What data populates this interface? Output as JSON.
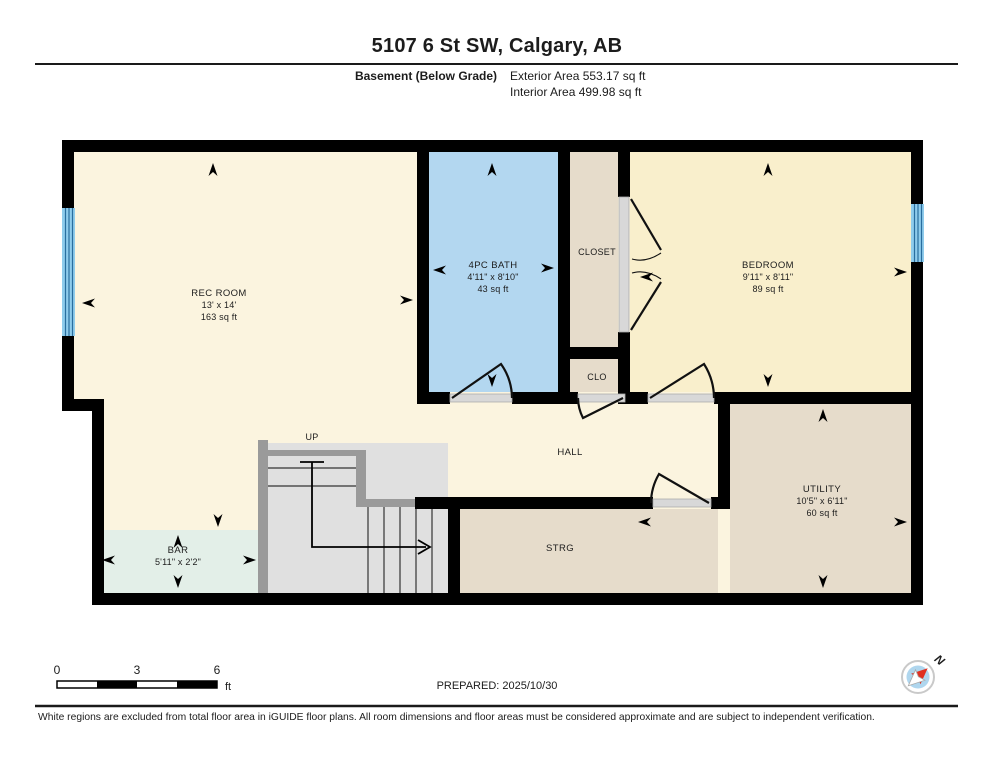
{
  "header": {
    "title": "5107 6 St SW, Calgary, AB",
    "floor_label": "Basement (Below Grade)",
    "exterior_area": "Exterior Area 553.17 sq ft",
    "interior_area": "Interior Area 499.98 sq ft"
  },
  "rooms": {
    "rec_room": {
      "name": "REC ROOM",
      "dims": "13' x 14'",
      "area": "163 sq ft"
    },
    "bath": {
      "name": "4PC BATH",
      "dims": "4'11\" x 8'10\"",
      "area": "43 sq ft"
    },
    "closet": {
      "name": "CLOSET"
    },
    "bedroom": {
      "name": "BEDROOM",
      "dims": "9'11\" x 8'11\"",
      "area": "89 sq ft"
    },
    "clo": {
      "name": "CLO"
    },
    "hall": {
      "name": "HALL"
    },
    "utility": {
      "name": "UTILITY",
      "dims": "10'5\" x 6'11\"",
      "area": "60 sq ft"
    },
    "strg": {
      "name": "STRG"
    },
    "bar": {
      "name": "BAR",
      "dims": "5'11\" x 2'2\""
    },
    "stairs": {
      "label": "UP"
    }
  },
  "scale_bar": {
    "tick_0": "0",
    "tick_3": "3",
    "tick_6": "6",
    "unit": "ft"
  },
  "prepared": "PREPARED: 2025/10/30",
  "compass": {
    "label": "N"
  },
  "footer": {
    "disclaimer": "White regions are excluded from total floor area in iGUIDE floor plans. All room dimensions and floor areas must be considered approximate and are subject to independent verification."
  },
  "colors": {
    "wall": "#000000",
    "room_cream": "#FBF4DF",
    "bedroom_yellow": "#F9EFCC",
    "bath_blue": "#B3D7F0",
    "storage_tan": "#E6DCCB",
    "bar_mint": "#E3EFE8",
    "stairs_gray": "#E0E0E0",
    "window_blue": "#8FCCEC",
    "compass_red": "#E03020",
    "sill_gray": "#D8D8D8"
  }
}
